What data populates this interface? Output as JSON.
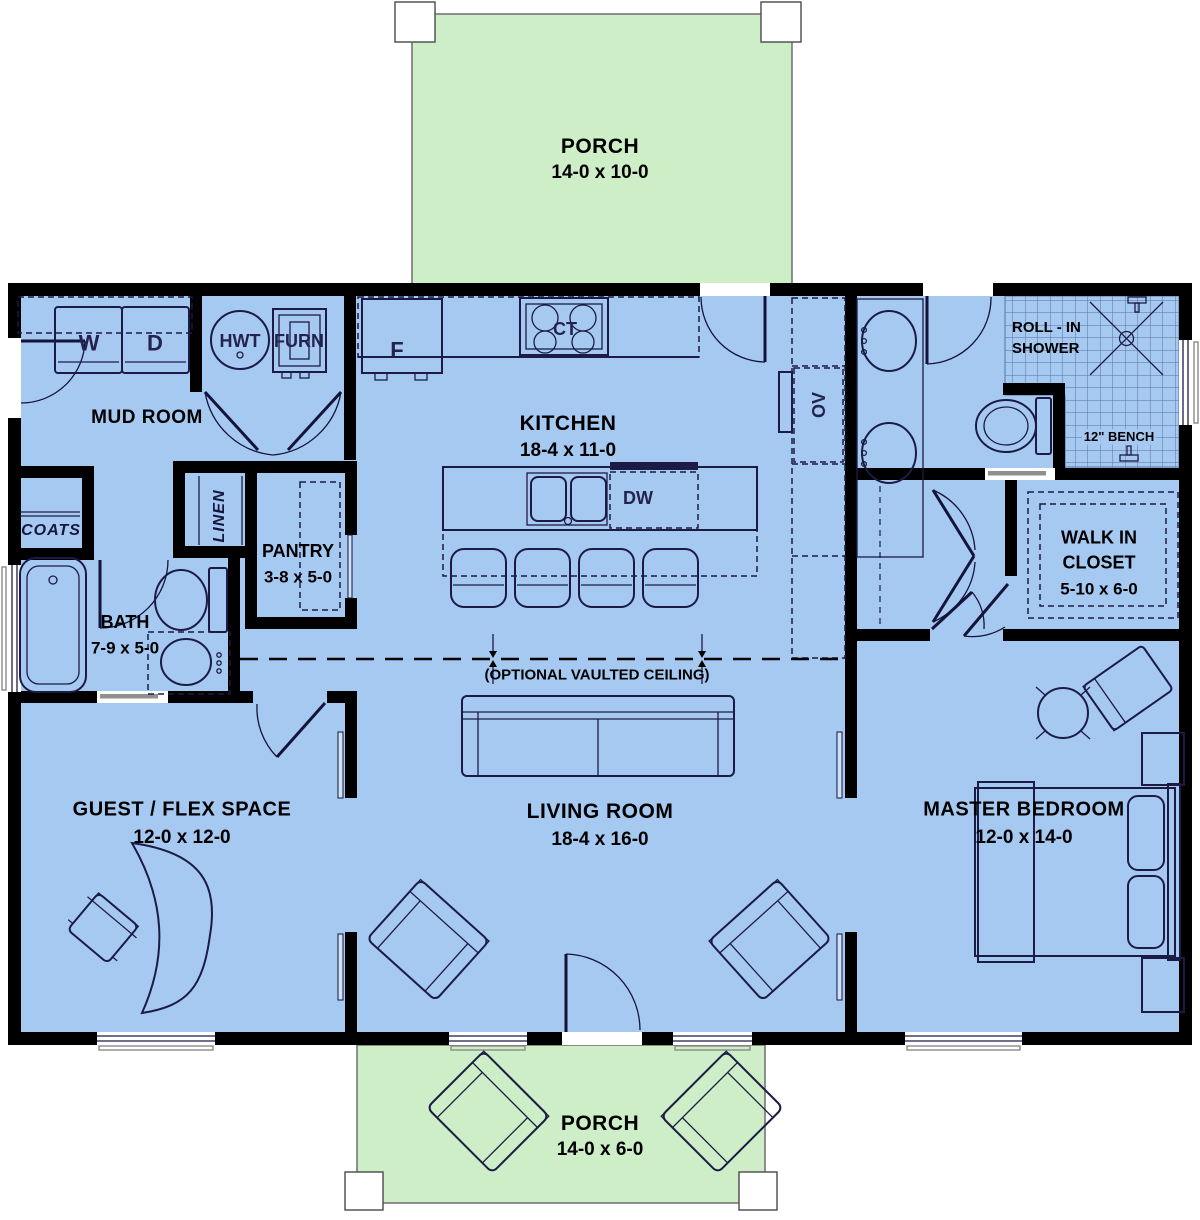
{
  "colors": {
    "floor": "#a6c9f2",
    "porch": "#cdeec6",
    "wall": "#000000",
    "furniture": "#1b1b45"
  },
  "rooms": {
    "porch_top": {
      "name": "PORCH",
      "dims": "14-0 x 10-0"
    },
    "mud_room": {
      "name": "MUD ROOM"
    },
    "kitchen": {
      "name": "KITCHEN",
      "dims": "18-4 x 11-0"
    },
    "pantry": {
      "name": "PANTRY",
      "dims": "3-8 x 5-0"
    },
    "bath": {
      "name": "BATH",
      "dims": "7-9 x 5-0"
    },
    "coats": {
      "name": "COATS"
    },
    "linen": {
      "name": "LINEN"
    },
    "guest": {
      "name": "GUEST / FLEX SPACE",
      "dims": "12-0 x 12-0"
    },
    "living": {
      "name": "LIVING ROOM",
      "dims": "18-4 x 16-0"
    },
    "master": {
      "name": "MASTER BEDROOM",
      "dims": "12-0 x 14-0"
    },
    "walk_in_closet": {
      "line1": "WALK IN",
      "line2": "CLOSET",
      "dims": "5-10 x 6-0"
    },
    "shower": {
      "line1": "ROLL - IN",
      "line2": "SHOWER"
    },
    "bench": {
      "name": "12\" BENCH"
    },
    "porch_bottom": {
      "name": "PORCH",
      "dims": "14-0 x 6-0"
    }
  },
  "annotations": {
    "vaulted_ceiling": "(OPTIONAL VAULTED CEILING)"
  },
  "appliances": {
    "washer": "W",
    "dryer": "D",
    "water_heater": "HWT",
    "furnace": "FURN",
    "fridge": "F",
    "cooktop": "CT",
    "dishwasher": "DW",
    "oven": "OV"
  }
}
